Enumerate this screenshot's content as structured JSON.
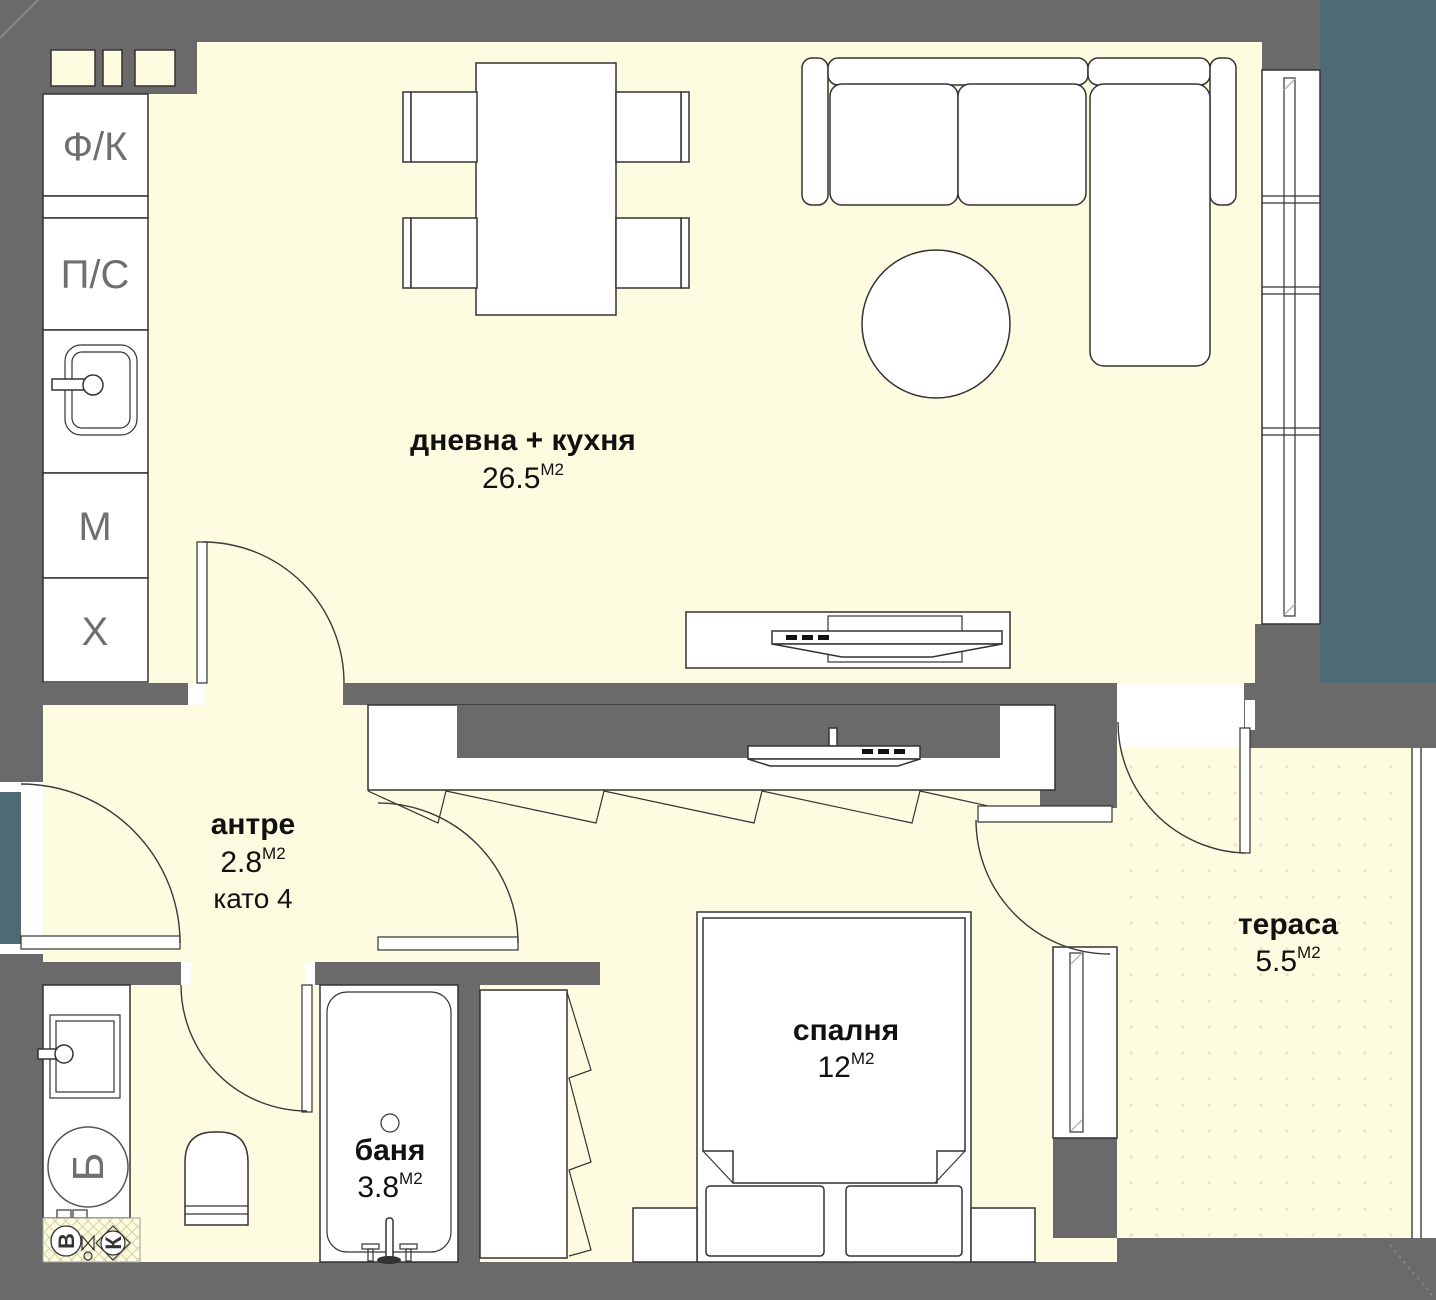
{
  "title": "apartment floor plan",
  "rooms": [
    {
      "name": "дневна + кухня",
      "area": "26.5",
      "unit": "М2"
    },
    {
      "name": "антре",
      "area": "2.8",
      "unit": "М2",
      "note": "като 4"
    },
    {
      "name": "баня",
      "area": "3.8",
      "unit": "М2"
    },
    {
      "name": "спалня",
      "area": "12",
      "unit": "М2"
    },
    {
      "name": "тераса",
      "area": "5.5",
      "unit": "М2"
    }
  ],
  "kitchen_units": [
    "Ф/К",
    "П/С",
    "М",
    "Х"
  ],
  "utility_symbols": {
    "boiler": "Б",
    "water": "В",
    "sewer": "К"
  },
  "colors": {
    "floor": "#FDFCE0",
    "wall": "#6A6A6A",
    "exterior": "#4E6A74",
    "line": "#333333",
    "terrace_dots": "#EBE5C2"
  }
}
